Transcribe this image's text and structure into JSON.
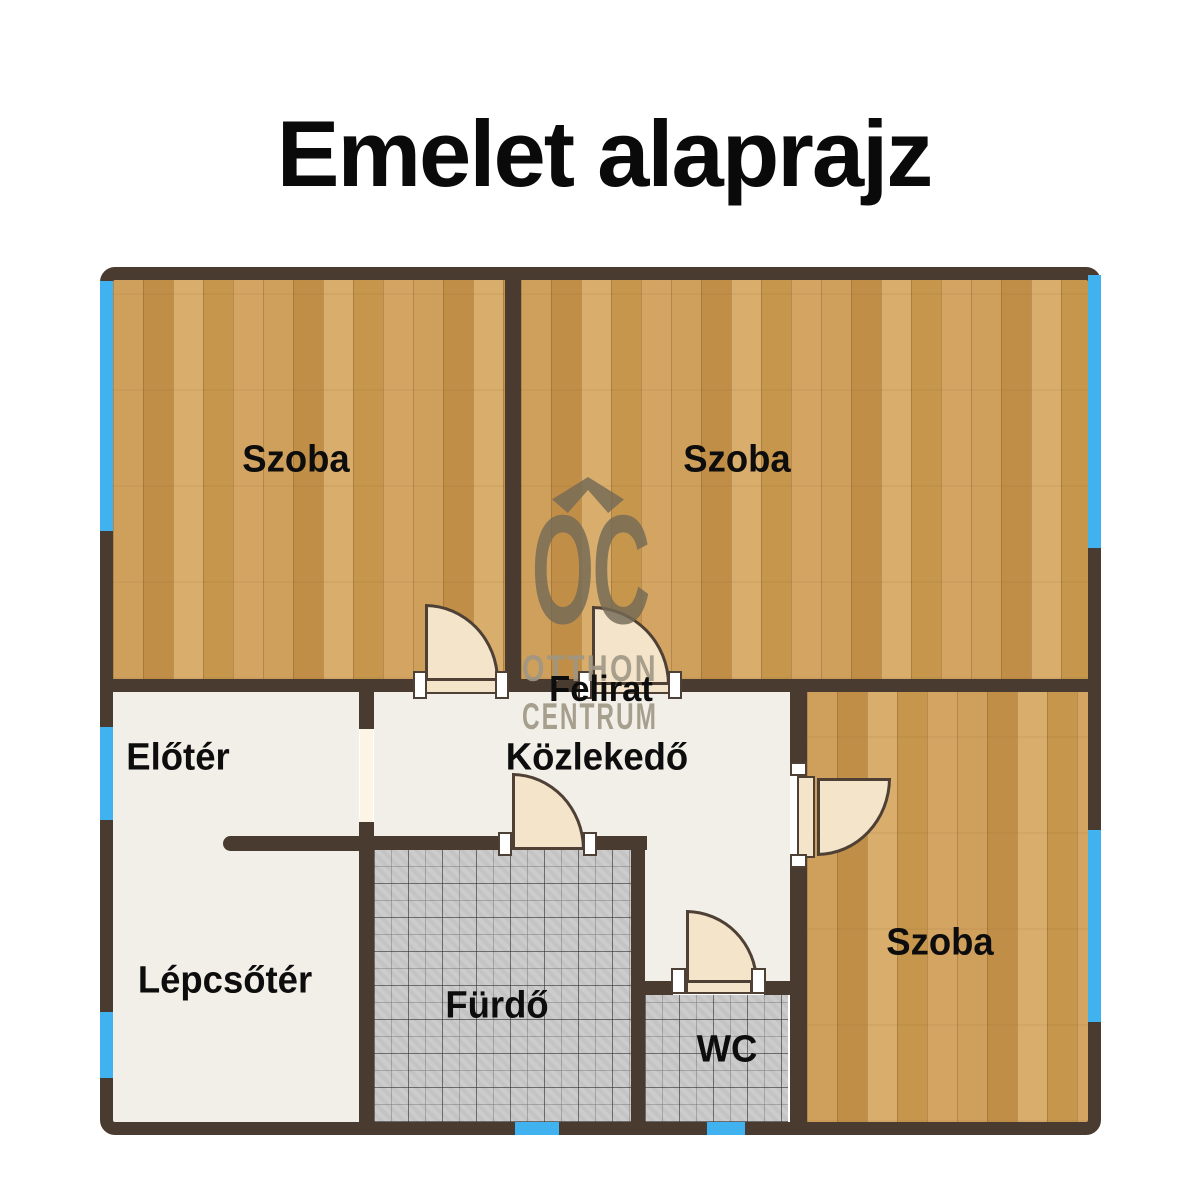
{
  "title": "Emelet alaprajz",
  "watermark": {
    "logo": "OC",
    "line1": "OTTHON",
    "line2": "CENTRUM"
  },
  "rooms": [
    {
      "id": "szoba-top-left",
      "label": "Szoba"
    },
    {
      "id": "szoba-top-right",
      "label": "Szoba"
    },
    {
      "id": "szoba-right",
      "label": "Szoba"
    },
    {
      "id": "eloter",
      "label": "Előtér"
    },
    {
      "id": "lepcsoter",
      "label": "Lépcsőtér"
    },
    {
      "id": "kozlekedo",
      "label": "Közlekedő"
    },
    {
      "id": "furdo",
      "label": "Fürdő"
    },
    {
      "id": "wc",
      "label": "WC"
    }
  ],
  "annotation": {
    "label": "Felirat"
  },
  "colors": {
    "wall": "#4a3b30",
    "wood_floor": "#cf9f5c",
    "tile_floor": "#c8c8c8",
    "light_floor": "#f1efe8",
    "window_blue": "#41b2f0",
    "door_cream": "#f3e4ca"
  }
}
